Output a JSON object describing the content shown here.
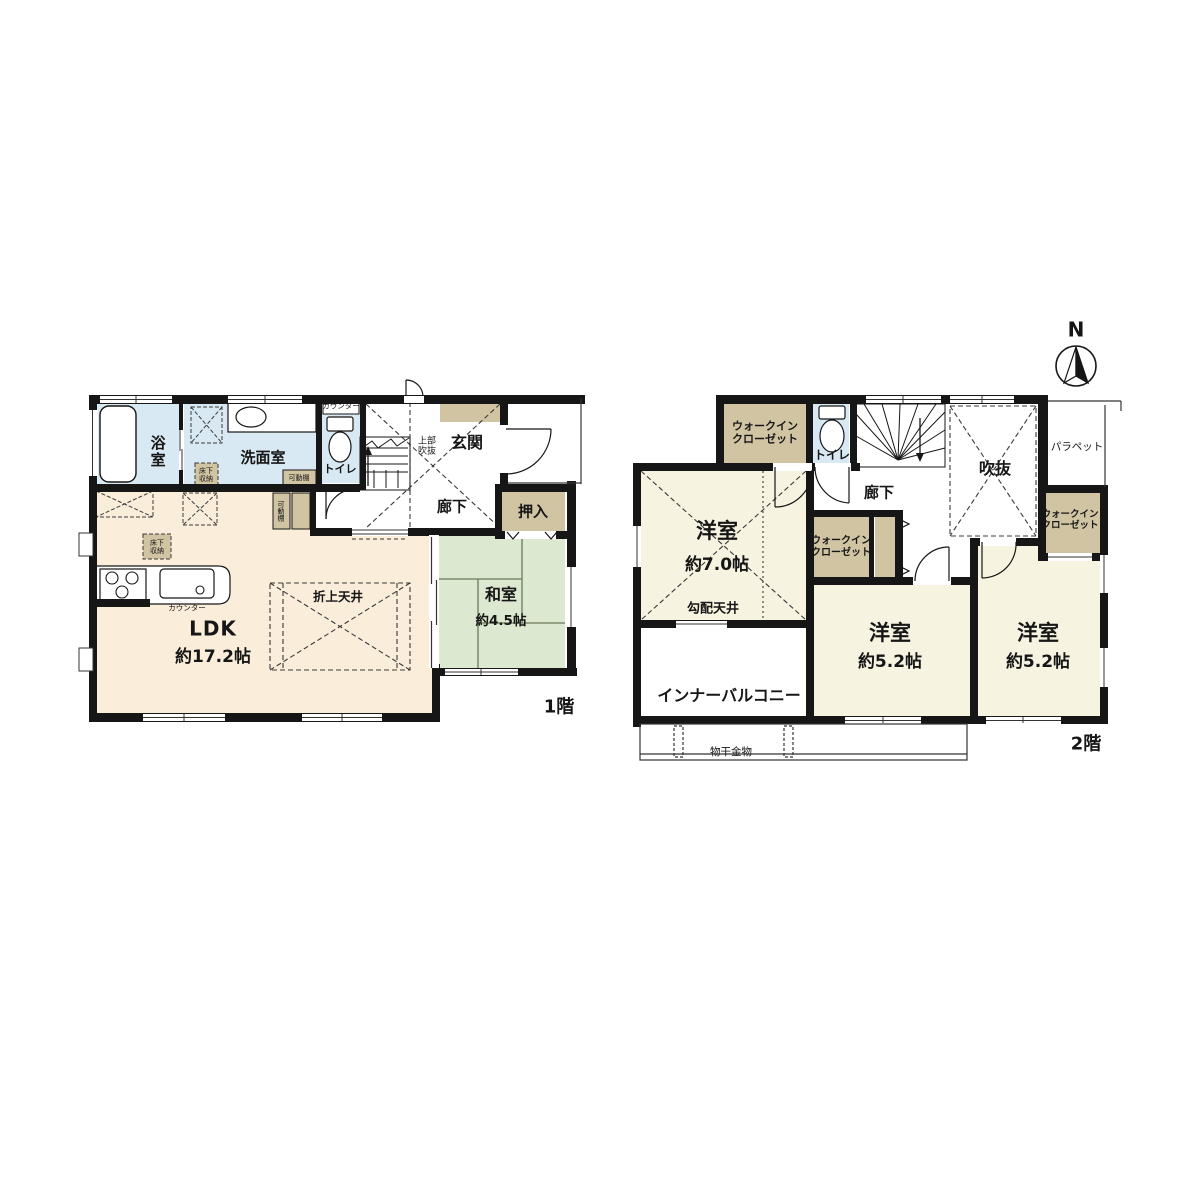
{
  "compass": {
    "north_label": "N"
  },
  "floor1": {
    "floor_label": "1階",
    "bath": "浴室",
    "washroom": "洗面室",
    "toilet": "トイレ",
    "toilet_counter": "カウンター",
    "movable_shelf_washroom": "可動棚",
    "movable_shelf_hall": "可動棚",
    "underfloor_storage_washroom": {
      "l1": "床下",
      "l2": "収納"
    },
    "underfloor_storage_ldk": {
      "l1": "床下",
      "l2": "収納"
    },
    "entrance": "玄関",
    "upper_void": {
      "l1": "上部",
      "l2": "吹抜"
    },
    "hallway": "廊下",
    "oshiire": "押入",
    "washitsu": "和室",
    "washitsu_size": "約4.5帖",
    "ldk": "LDK",
    "ldk_size": "約17.2帖",
    "coffered_ceiling": "折上天井",
    "kitchen_counter": "カウンター"
  },
  "floor2": {
    "floor_label": "2階",
    "wic1": {
      "l1": "ウォークイン",
      "l2": "クローゼット"
    },
    "wic2": {
      "l1": "ウォークイン",
      "l2": "クローゼット"
    },
    "wic3": {
      "l1": "ウォークイン",
      "l2": "クローゼット"
    },
    "toilet": "トイレ",
    "hallway": "廊下",
    "void": "吹抜",
    "parapet": "パラペット",
    "bedroom1": "洋室",
    "bedroom1_size": "約7.0帖",
    "sloped_ceiling": "勾配天井",
    "bedroom2": "洋室",
    "bedroom2_size": "約5.2帖",
    "bedroom3": "洋室",
    "bedroom3_size": "約5.2帖",
    "inner_balcony": "インナーバルコニー",
    "laundry_hardware": "物干金物"
  },
  "colors": {
    "wall": "#161616",
    "ldk_cream": "#faeedb",
    "room_ivory": "#f7f3e1",
    "tatami_green": "#dde8d0",
    "water_blue": "#d9e9f3",
    "closet_tan": "#d1c4a3"
  }
}
